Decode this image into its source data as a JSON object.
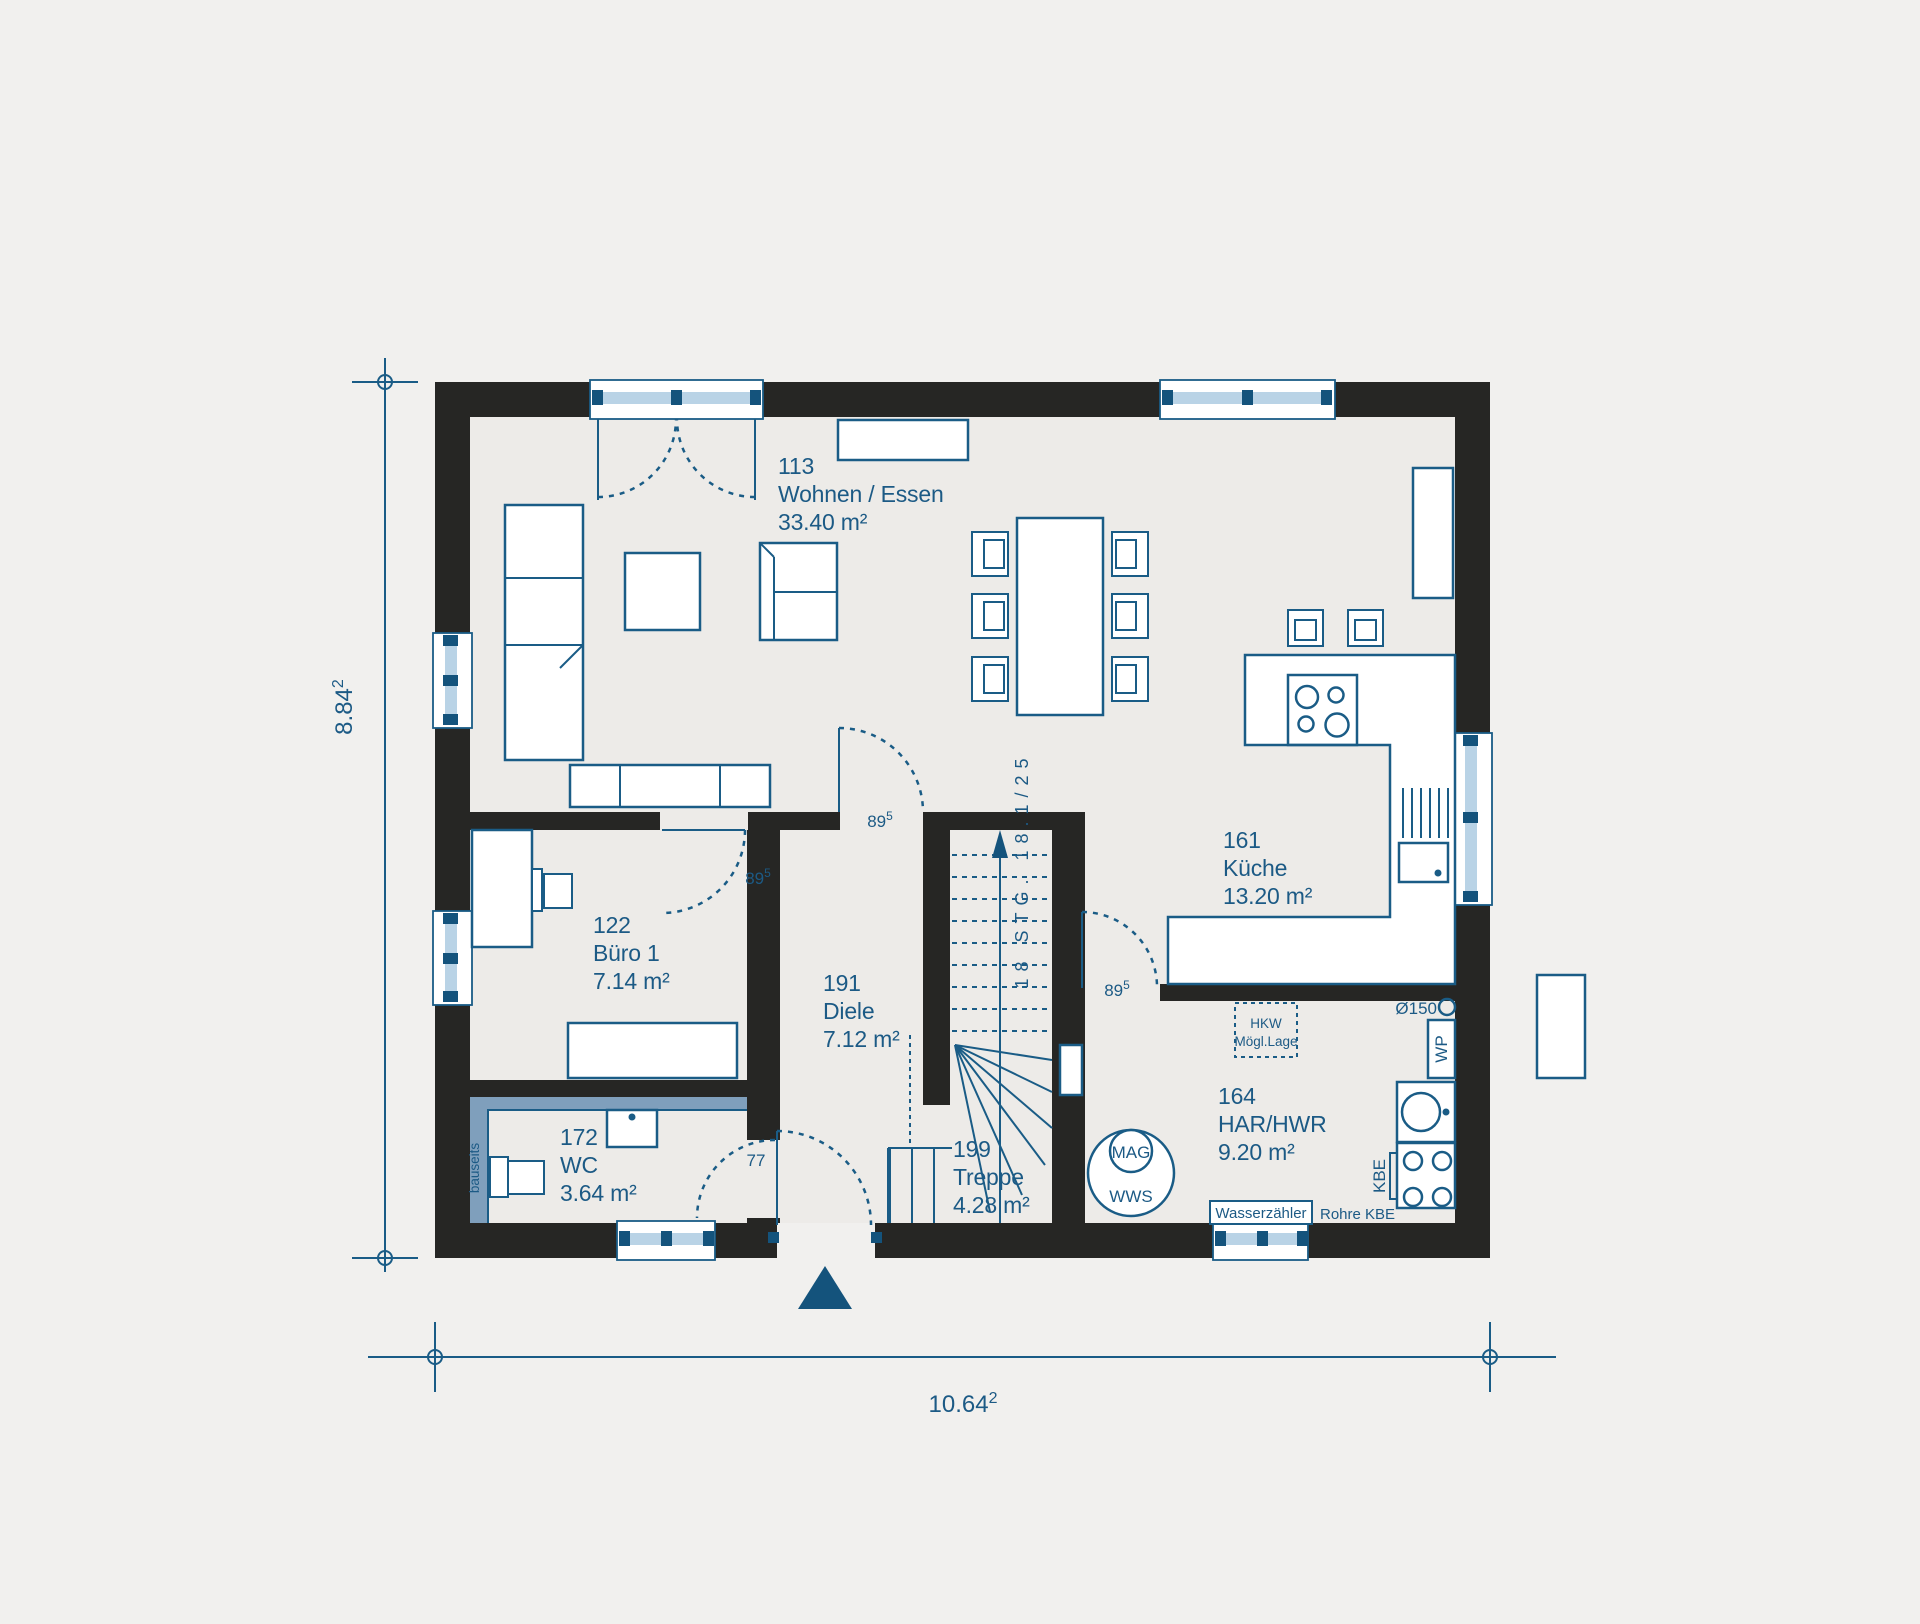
{
  "colors": {
    "background": "#f1f0ee",
    "floor": "#edebe8",
    "wall": "#262624",
    "line_blue": "#1a5c86",
    "dark_blue": "#14537c",
    "text_blue": "#1c5a85",
    "window_glass": "#b9d3e6",
    "bauseits_band": "#7f9fbc"
  },
  "dimensions": {
    "width": {
      "value": "10.64",
      "sup": "2"
    },
    "height": {
      "value": "8.84",
      "sup": "2"
    }
  },
  "rooms": {
    "wohnen": {
      "number": "113",
      "name": "Wohnen / Essen",
      "area": "33.40 m²"
    },
    "kueche": {
      "number": "161",
      "name": "Küche",
      "area": "13.20 m²"
    },
    "buero": {
      "number": "122",
      "name": "Büro 1",
      "area": "7.14 m²"
    },
    "diele": {
      "number": "191",
      "name": "Diele",
      "area": "7.12 m²"
    },
    "wc": {
      "number": "172",
      "name": "WC",
      "area": "3.64 m²"
    },
    "treppe": {
      "number": "199",
      "name": "Treppe",
      "area": "4.28 m²"
    },
    "har": {
      "number": "164",
      "name": "HAR/HWR",
      "area": "9.20 m²"
    }
  },
  "doors": {
    "buero": {
      "value": "89",
      "sup": "5"
    },
    "wohnen": {
      "value": "89",
      "sup": "5"
    },
    "kueche": {
      "value": "89",
      "sup": "5"
    },
    "wc": {
      "value": "77"
    }
  },
  "stairs": {
    "label": "18 STG. 18.1/25"
  },
  "annotations": {
    "hkw": {
      "line1": "HKW",
      "line2": "Mögl.Lage"
    },
    "mag": "MAG",
    "wws": "WWS",
    "wasserzaehler": "Wasserzähler",
    "rohre_kbe": "Rohre KBE",
    "kbe": "KBE",
    "wp": "WP",
    "vent": "Ø150",
    "bauseits": "bauseits"
  }
}
